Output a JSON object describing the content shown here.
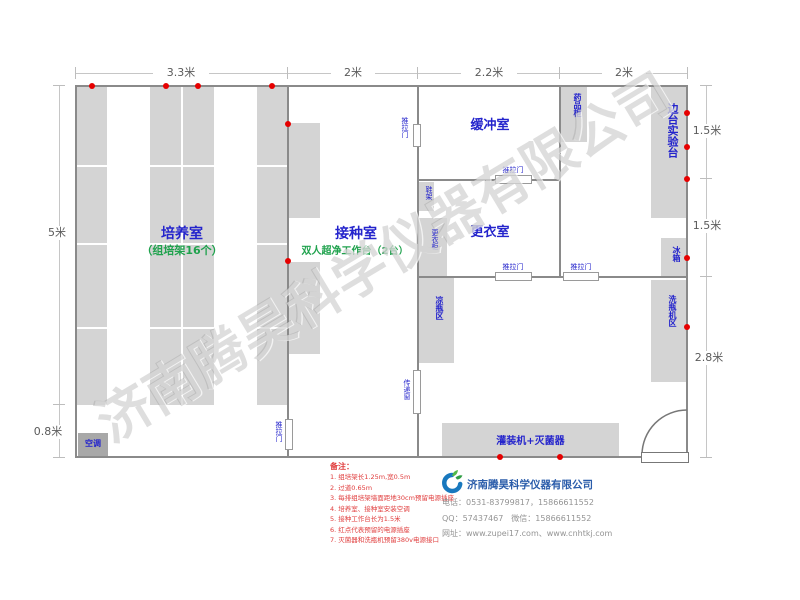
{
  "watermark": "济南腾昊科学仪器有限公司",
  "dims": {
    "top": [
      "3.3米",
      "2米",
      "2.2米",
      "2米"
    ],
    "left": [
      "5米",
      "0.8米"
    ],
    "right": [
      "1.5米",
      "1.5米",
      "2.8米"
    ]
  },
  "rooms": {
    "culture_name": "培养室",
    "culture_sub": "（组培架16个）",
    "inoculation_name": "接种室",
    "inoculation_sub": "双人超净工作台（2台）",
    "buffer_name": "缓冲室",
    "changing_name": "更衣室"
  },
  "fixtures": {
    "sliding_door": "推拉门",
    "medicine_cabinet": "药品柜",
    "side_bench": "边台实验台",
    "fridge": "冰箱",
    "bottle_washer_area": "洗瓶机区",
    "bottle_cooling_area": "凉瓶区",
    "transfer_window": "传递窗",
    "shoe_rack": "鞋架",
    "wardrobe": "更衣柜",
    "air_conditioner": "空调",
    "filling_sterilizer": "灌装机+灭菌器"
  },
  "notes": {
    "title": "备注：",
    "items": [
      "1. 组培架长1.25m,宽0.5m",
      "2. 过道0.65m",
      "3. 每排组培架墙面距地30cm预留电源插座",
      "4. 培养室、接种室安装空调",
      "5. 接种工作台长为1.5米",
      "6. 红点代表预留的电源插座",
      "7. 灭菌器和洗瓶机预留380v电源接口"
    ]
  },
  "company": {
    "name": "济南腾昊科学仪器有限公司",
    "phone": "电话：0531-83799817，15866611552",
    "qq": "QQ：57437467　微信：15866611552",
    "web": "网址：www.zupei17.com、www.cnhtkj.com"
  },
  "colors": {
    "room_label": "#2424cc",
    "sub_label": "#1fa24d",
    "wall": "#8a8a8a",
    "furniture": "#d4d4d4",
    "power_dot": "#e60000",
    "note_text": "#e03c3c",
    "brand_blue": "#2a5caa",
    "logo_green": "#3cb54a"
  }
}
